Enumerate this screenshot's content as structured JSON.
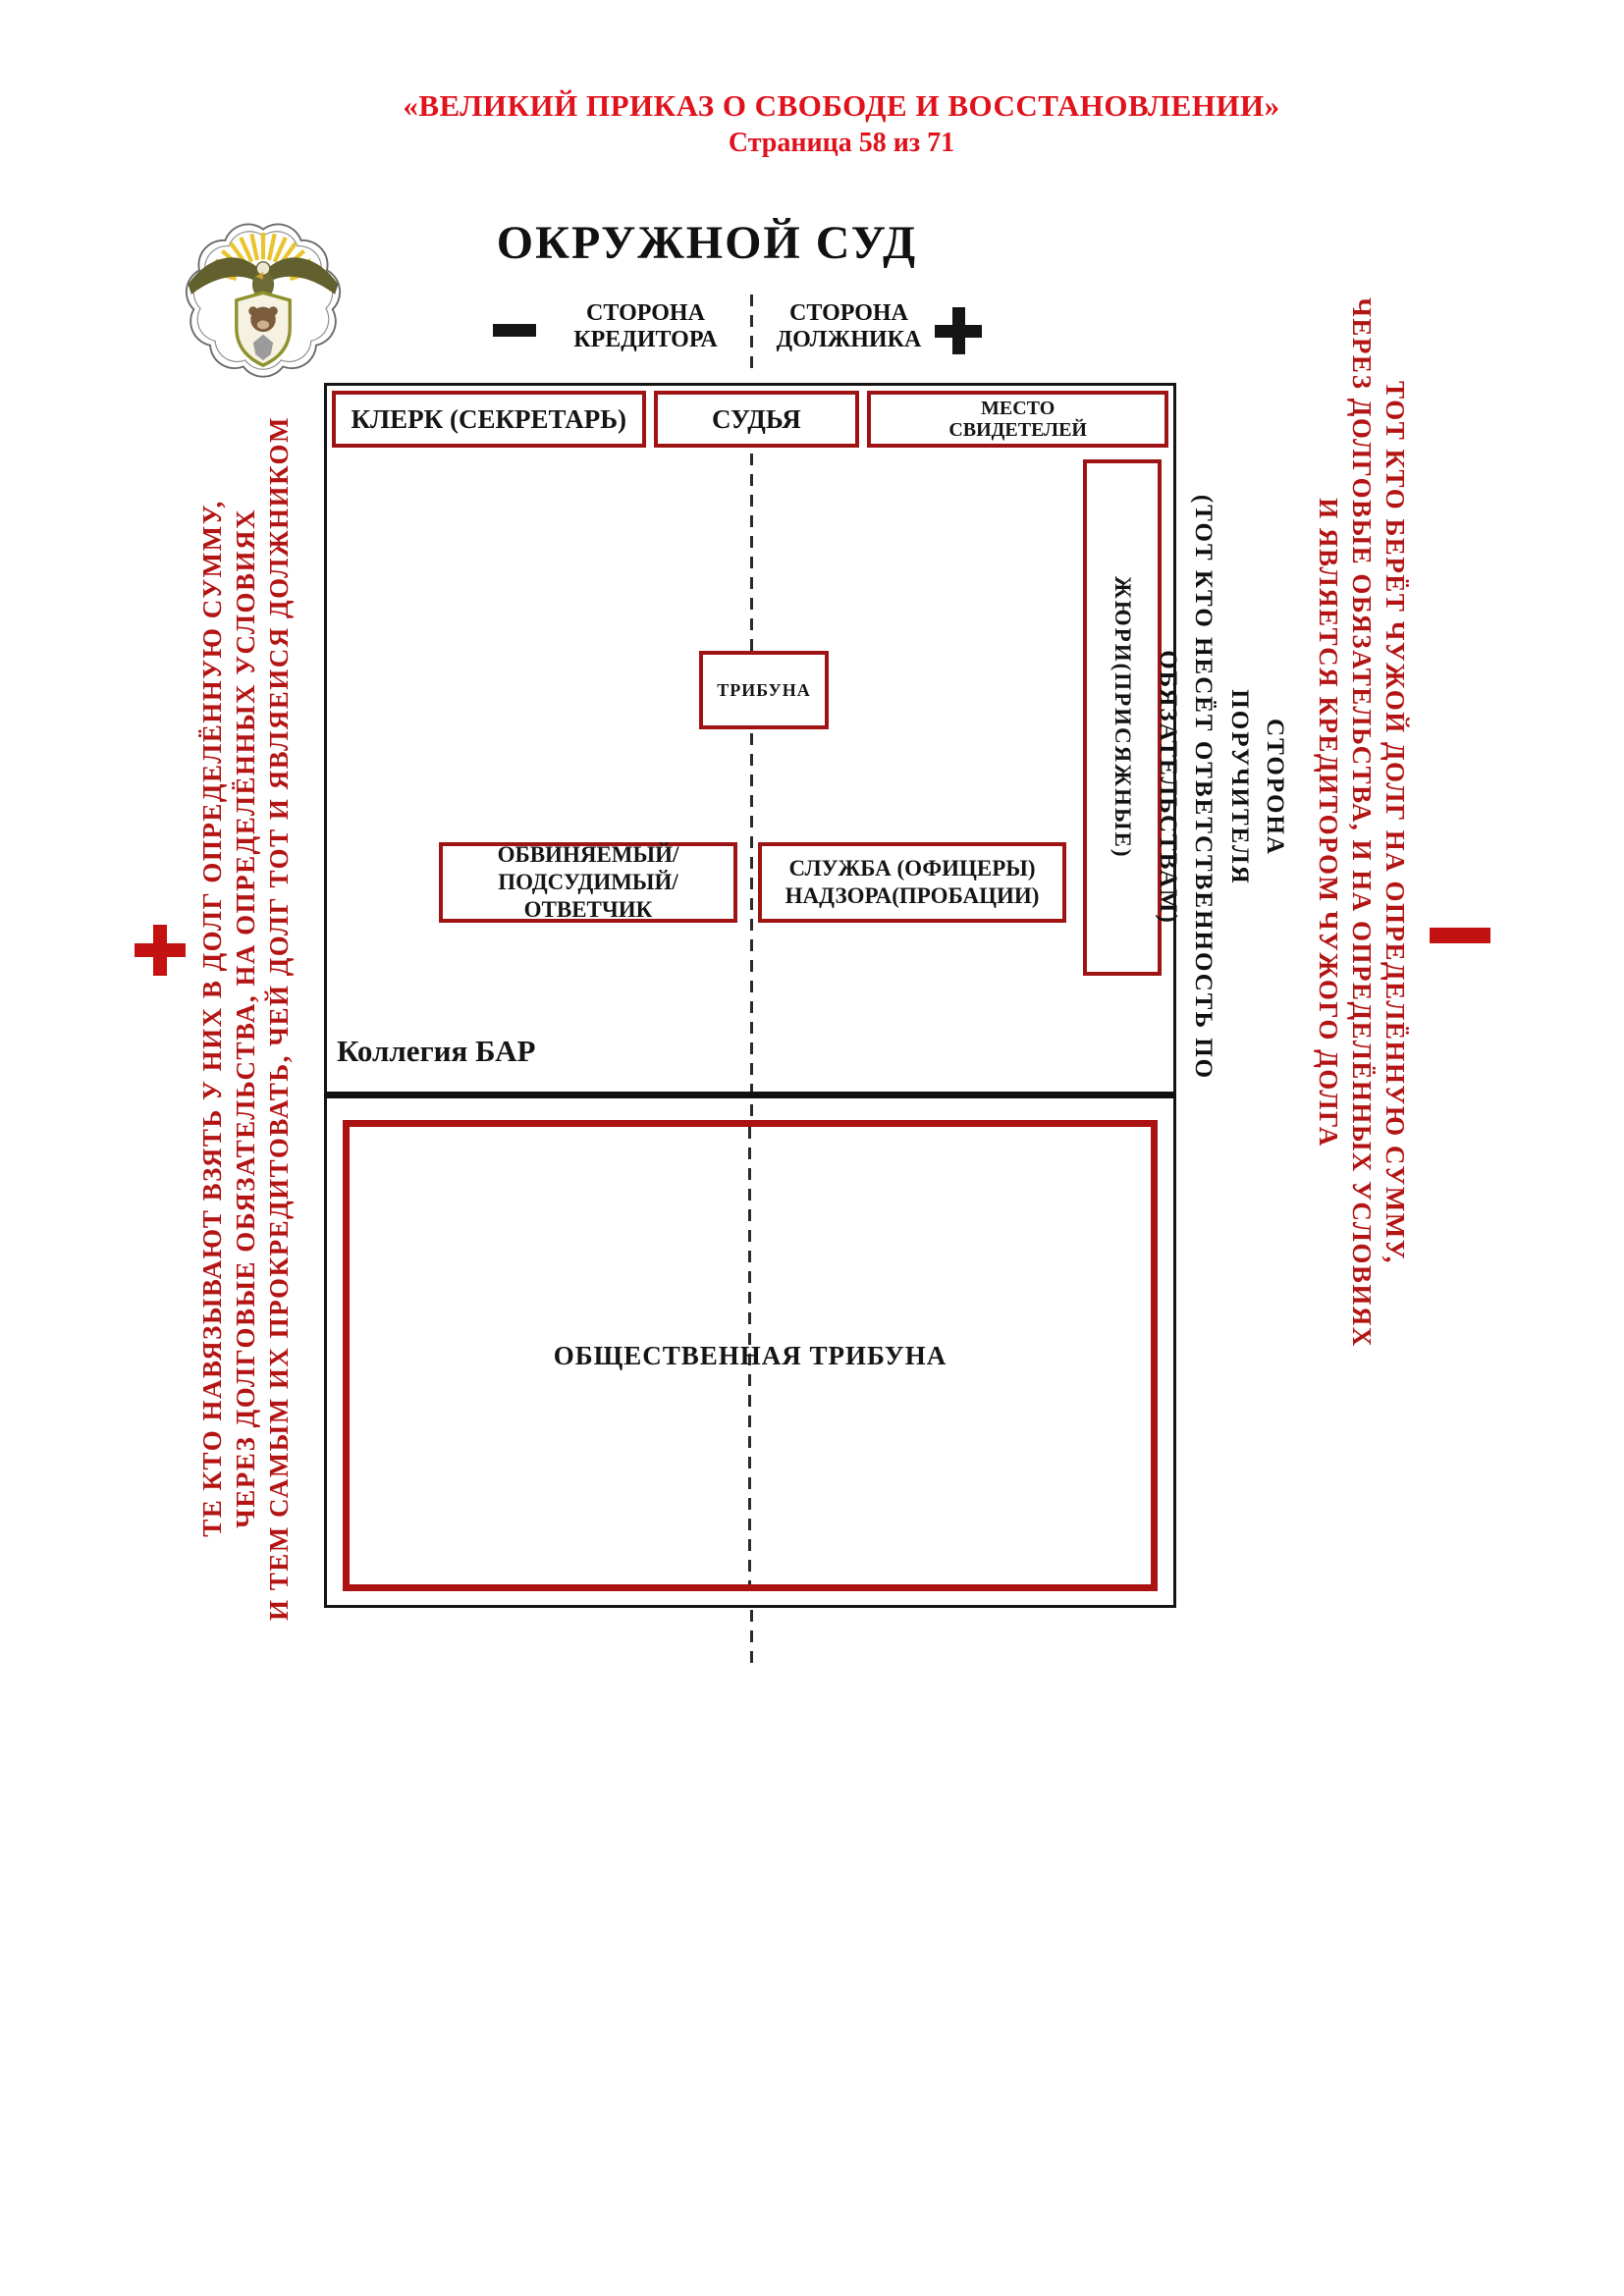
{
  "header": {
    "title": "«ВЕЛИКИЙ ПРИКАЗ О СВОБОДЕ И ВОССТАНОВЛЕНИИ»",
    "page_info": "Страница 58 из 71"
  },
  "court": {
    "title": "ОКРУЖНОЙ СУД",
    "creditor_side_label": "СТОРОНА\nКРЕДИТОРА",
    "debtor_side_label": "СТОРОНА\nДОЛЖНИКА"
  },
  "room": {
    "clerk": "КЛЕРК (СЕКРЕТАРЬ)",
    "judge": "СУДЬЯ",
    "witness_stand": "МЕСТО\nСВИДЕТЕЛЕЙ",
    "jury": "ЖЮРИ(ПРИСЯЖНЫЕ)",
    "tribune": "ТРИБУНА",
    "defendant": "ОБВИНЯЕМЫЙ/\nПОДСУДИМЫЙ/ОТВЕТЧИК",
    "probation": "СЛУЖБА (ОФИЦЕРЫ)\nНАДЗОРА(ПРОБАЦИИ)",
    "bar_college": "Коллегия БАР",
    "public_tribune": "ОБЩЕСТВЕННАЯ ТРИБУНА"
  },
  "guarantor_note": {
    "lines": [
      "СТОРОНА",
      "ПОРУЧИТЕЛЯ",
      "(ТОТ КТО НЕСЁТ ОТВЕТСТВЕННОСТЬ ПО ОБЯЗАТЕЛЬСТВАМ)"
    ]
  },
  "left_note": {
    "lines": [
      "ТЕ КТО НАВЯЗЫВАЮТ ВЗЯТЬ У НИХ В ДОЛГ ОПРЕДЕЛЁННУЮ СУММУ,",
      "ЧЕРЕЗ ДОЛГОВЫЕ ОБЯЗАТЕЛЬСТВА, НА ОПРЕДЕЛЁННЫХ УСЛОВИЯХ",
      "И ТЕМ САМЫМ ИХ ПРОКРЕДИТОВАТЬ, ЧЕЙ ДОЛГ ТОТ И ЯВЛЯЕИСЯ ДОЛЖНИКОМ"
    ]
  },
  "right_note": {
    "lines": [
      "ТОТ КТО БЕРЁТ ЧУЖОЙ ДОЛГ НА ОПРЕДЕЛЁННУЮ СУММУ,",
      "ЧЕРЕЗ ДОЛГОВЫЕ ОБЯЗАТЕЛЬСТВА, И НА ОПРЕДЕЛЁННЫХ УСЛОВИЯХ",
      "И ЯВЛЯЕТСЯ КРЕДИТОРОМ ЧУЖОГО ДОЛГА"
    ]
  },
  "colors": {
    "title_red": "#e0121c",
    "note_red": "#b31414",
    "sign_red": "#c41212",
    "box_border_red": "#9e1414",
    "public_border_red": "#ad1212",
    "black": "#151515",
    "ray_gold": "#e9c42e"
  }
}
